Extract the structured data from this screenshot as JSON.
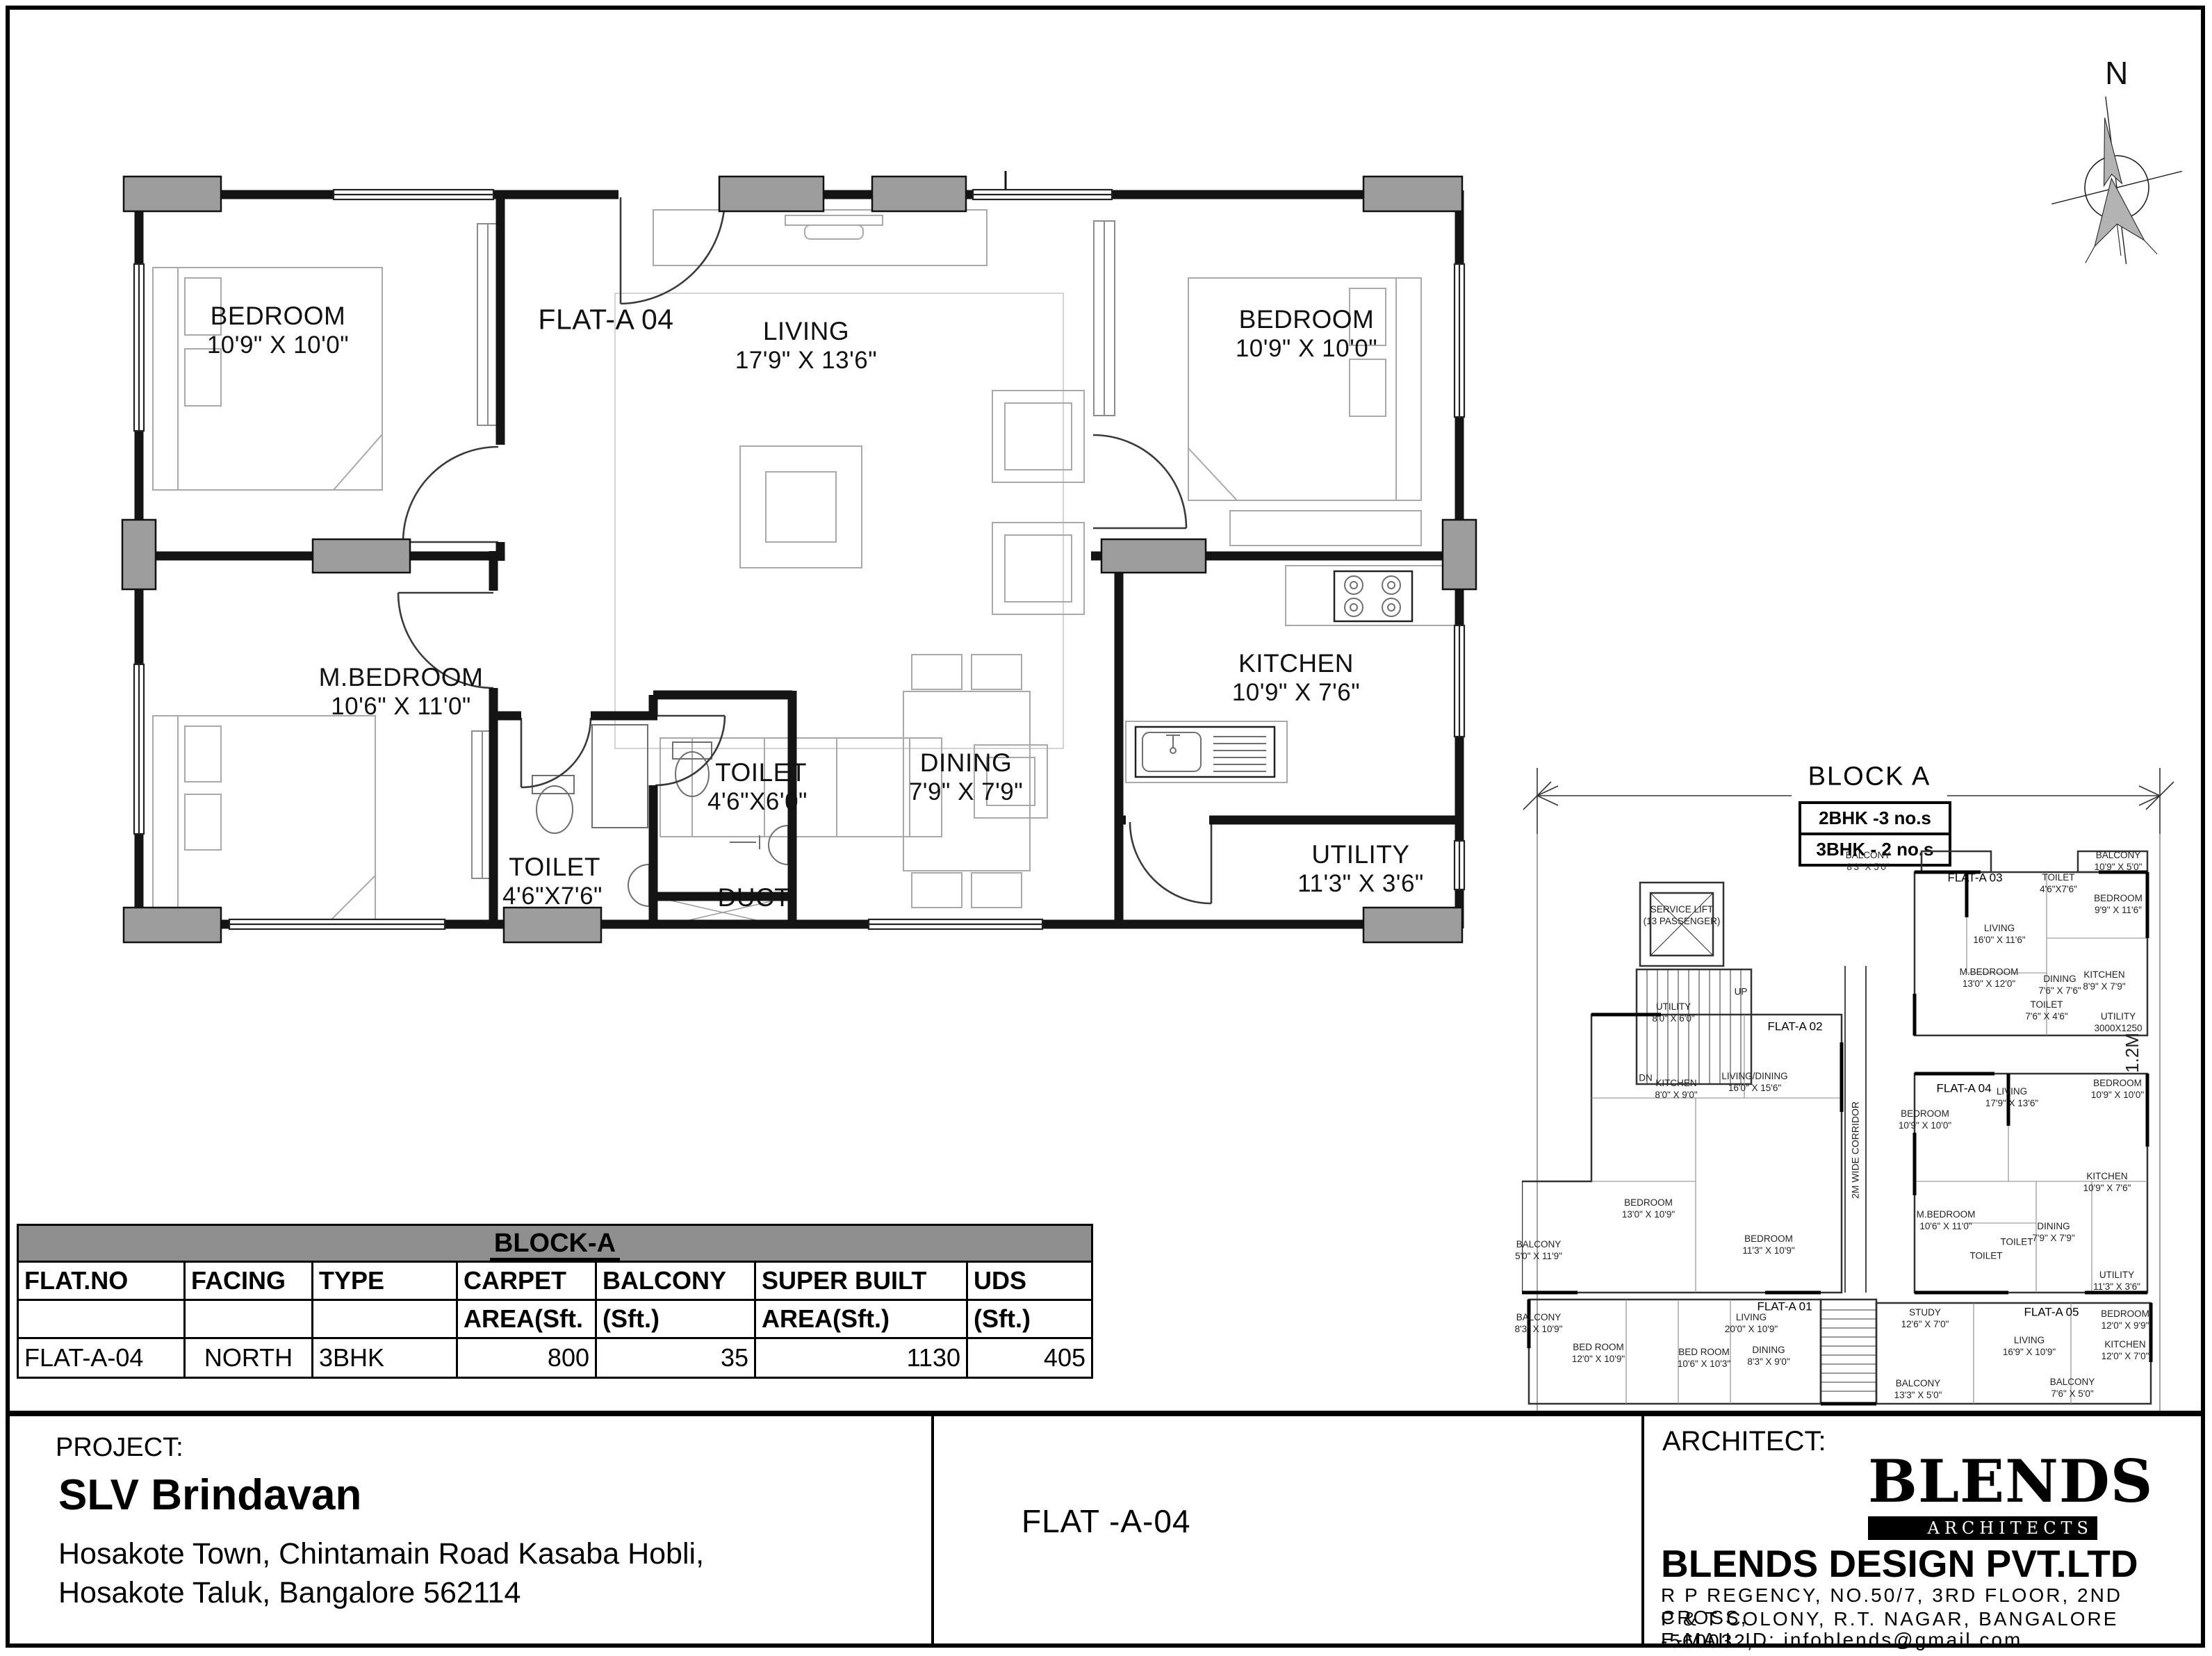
{
  "compass": {
    "label": "N"
  },
  "main_plan": {
    "flat_label": "FLAT-A 04",
    "rooms": [
      {
        "name": "BEDROOM",
        "dims": "10'9\" X 10'0\""
      },
      {
        "name": "LIVING",
        "dims": "17'9\" X 13'6\""
      },
      {
        "name": "BEDROOM",
        "dims": "10'9\" X 10'0\""
      },
      {
        "name": "M.BEDROOM",
        "dims": "10'6\" X 11'0\""
      },
      {
        "name": "TOILET",
        "dims": "4'6\"X7'6\""
      },
      {
        "name": "TOILET",
        "dims": "4'6\"X6'0\""
      },
      {
        "name": "DUCT",
        "dims": ""
      },
      {
        "name": "DINING",
        "dims": "7'9\" X 7'9\""
      },
      {
        "name": "KITCHEN",
        "dims": "10'9\" X 7'6\""
      },
      {
        "name": "UTILITY",
        "dims": "11'3\" X 3'6\""
      }
    ]
  },
  "key_plan": {
    "title": "BLOCK A",
    "legend": [
      "2BHK -3 no.s",
      "3BHK - 2 no.s"
    ],
    "labels": [
      "FLAT-A 01",
      "FLAT-A 02",
      "FLAT-A 03",
      "FLAT-A 04",
      "FLAT-A 05",
      "SERVICE LIFT\n(13 PASSENGER)",
      "LIVING\n16'0\" X 11'6\"",
      "TOILET\n4'6\"X7'6\"",
      "BEDROOM\n9'9\" X 11'6\"",
      "M.BEDROOM\n13'0\" X 12'0\"",
      "DINING\n7'6\" X 7'6\"",
      "KITCHEN\n8'9\" X 7'9\"",
      "TOILET\n7'6\" X 4'6\"",
      "UTILITY\n3000X1250",
      "BALCONY\n8'3\" X 5'0\"",
      "BALCONY\n10'9\" X 5'0\"",
      "LIVING\n17'9\" X 13'6\"",
      "BEDROOM\n10'9\" X 10'0\"",
      "BEDROOM\n10'9\" X 10'0\"",
      "M.BEDROOM\n10'6\" X 11'0\"",
      "DINING\n7'9\" X 7'9\"",
      "KITCHEN\n10'9\" X 7'6\"",
      "UTILITY\n11'3\" X 3'6\"",
      "TOILET",
      "UTILITY\n8'0\" X 6'0\"",
      "KITCHEN\n8'0\" X 9'0\"",
      "LIVING/DINING\n16'0\" X 15'6\"",
      "BEDROOM\n13'0\" X 10'9\"",
      "BEDROOM\n11'3\" X 10'9\"",
      "BALCONY\n5'0\" X 11'9\"",
      "BALCONY\n8'3\" X 10'9\"",
      "BED ROOM\n12'0\" X 10'9\"",
      "LIVING\n20'0\" X 10'9\"",
      "STUDY\n12'6\" X 7'0\"",
      "LIVING\n16'9\" X 10'9\"",
      "BEDROOM\n12'0\" X 9'9\"",
      "BALCONY\n13'3\" X 5'0\"",
      "BALCONY\n7'6\" X 5'0\"",
      "UP",
      "DN",
      "2M WIDE CORRIDOR",
      "1.2M",
      "TOILET",
      "BED ROOM\n10'6\" X 10'3\"",
      "DINING\n8'3\" X 9'0\"",
      "KITCHEN\n12'0\" X 7'0\""
    ]
  },
  "area_table": {
    "title": "BLOCK-A",
    "columns": [
      {
        "l1": "FLAT.NO",
        "l2": ""
      },
      {
        "l1": "FACING",
        "l2": ""
      },
      {
        "l1": "TYPE",
        "l2": ""
      },
      {
        "l1": "CARPET",
        "l2": "AREA(Sft."
      },
      {
        "l1": "BALCONY",
        "l2": "(Sft.)"
      },
      {
        "l1": "SUPER BUILT",
        "l2": "AREA(Sft.)"
      },
      {
        "l1": "UDS",
        "l2": "(Sft.)"
      }
    ],
    "row": [
      "FLAT-A-04",
      "NORTH",
      "3BHK",
      "800",
      "35",
      "1130",
      "405"
    ]
  },
  "title_block": {
    "project_label": "PROJECT:",
    "project_name": "SLV Brindavan",
    "address1": "Hosakote Town, Chintamain Road Kasaba Hobli,",
    "address2": "Hosakote Taluk, Bangalore 562114",
    "sheet_title": "FLAT -A-04",
    "architect_label": "ARCHITECT:",
    "logo_text": "BLENDS",
    "logo_sub": "ARCHITECTS",
    "firm_name": "BLENDS DESIGN  PVT.LTD",
    "firm_addr1": "R P REGENCY, NO.50/7, 3RD FLOOR, 2ND CROSS,",
    "firm_addr2": "P & T COLONY, R.T. NAGAR, BANGALORE -560032,",
    "firm_addr3": "E-MAIL ID: infoblends@gmail.com"
  }
}
